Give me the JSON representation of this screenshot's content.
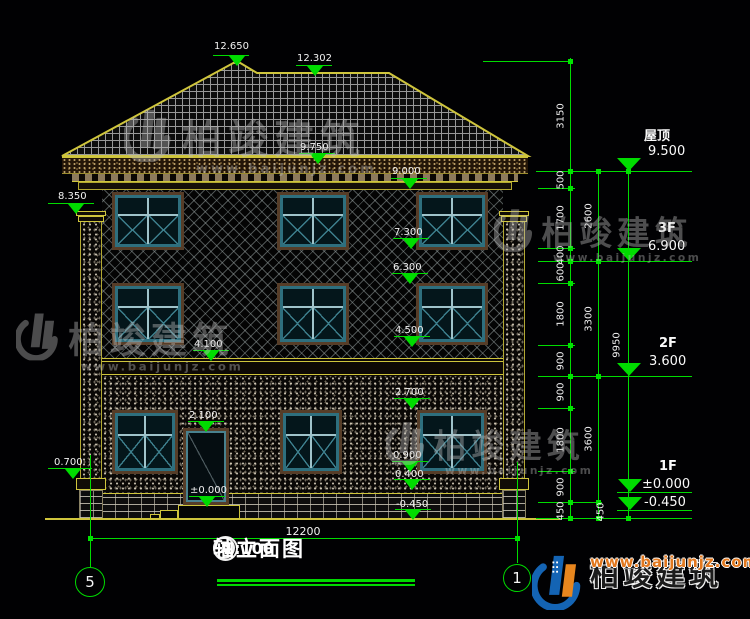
{
  "title": {
    "axis_left": "5",
    "axis_right": "1",
    "text": "轴立面图",
    "scale": "1:100"
  },
  "brand": {
    "name": "柏竣建筑",
    "url": "www.baijunjz.com"
  },
  "bottom_dim": {
    "label": "12200",
    "x1": 90,
    "x2": 517,
    "y": 538,
    "lx": 303,
    "ly": 525
  },
  "axis_bubbles": [
    {
      "label": "5",
      "cx": 90,
      "cy": 582,
      "r": 15,
      "line_top": 455,
      "line_bottom": 567
    },
    {
      "label": "1",
      "cx": 517,
      "cy": 578,
      "r": 14,
      "line_top": 462,
      "line_bottom": 563
    }
  ],
  "elevation_markers": [
    {
      "label": "12.650",
      "lx": 214,
      "ly": 41,
      "x1": 213,
      "x2": 249,
      "y": 55,
      "tx": 237
    },
    {
      "label": "12.302",
      "lx": 297,
      "ly": 53,
      "x1": 296,
      "x2": 332,
      "y": 65,
      "tx": 315
    },
    {
      "label": "9.750",
      "lx": 300,
      "ly": 142,
      "x1": 299,
      "x2": 335,
      "y": 153,
      "tx": 318
    },
    {
      "label": "9.000",
      "lx": 392,
      "ly": 166,
      "x1": 391,
      "x2": 427,
      "y": 178,
      "tx": 410
    },
    {
      "label": "8.350",
      "lx": 58,
      "ly": 191,
      "x1": 48,
      "x2": 94,
      "y": 203,
      "tx": 76
    },
    {
      "label": "7.300",
      "lx": 394,
      "ly": 227,
      "x1": 393,
      "x2": 429,
      "y": 238,
      "tx": 411
    },
    {
      "label": "6.300",
      "lx": 393,
      "ly": 262,
      "x1": 392,
      "x2": 428,
      "y": 273,
      "tx": 410
    },
    {
      "label": "4.500",
      "lx": 395,
      "ly": 325,
      "x1": 394,
      "x2": 430,
      "y": 336,
      "tx": 412
    },
    {
      "label": "4.100",
      "lx": 194,
      "ly": 339,
      "x1": 193,
      "x2": 229,
      "y": 350,
      "tx": 211
    },
    {
      "label": "2.700",
      "lx": 395,
      "ly": 387,
      "x1": 394,
      "x2": 430,
      "y": 398,
      "tx": 412
    },
    {
      "label": "2.100",
      "lx": 189,
      "ly": 410,
      "x1": 188,
      "x2": 224,
      "y": 421,
      "tx": 206
    },
    {
      "label": "0.900",
      "lx": 393,
      "ly": 450,
      "x1": 392,
      "x2": 428,
      "y": 461,
      "tx": 410
    },
    {
      "label": "0.400",
      "lx": 395,
      "ly": 469,
      "x1": 394,
      "x2": 430,
      "y": 479,
      "tx": 412
    },
    {
      "label": "±0.000",
      "lx": 190,
      "ly": 485,
      "x1": 189,
      "x2": 225,
      "y": 496,
      "tx": 207
    },
    {
      "label": "-0.450",
      "lx": 396,
      "ly": 499,
      "x1": 395,
      "x2": 431,
      "y": 509,
      "tx": 413
    },
    {
      "label": "0.700",
      "lx": 54,
      "ly": 457,
      "x1": 48,
      "x2": 92,
      "y": 468,
      "tx": 73
    }
  ],
  "level_markers": [
    {
      "floor": "屋顶",
      "fx": 644,
      "fy": 125,
      "value": "9.500",
      "vx": 648,
      "vy": 144,
      "tx": 629,
      "ty": 171
    },
    {
      "floor": "3F",
      "fx": 658,
      "fy": 221,
      "value": "6.900",
      "vx": 648,
      "vy": 239,
      "tx": 629,
      "ty": 261
    },
    {
      "floor": "2F",
      "fx": 659,
      "fy": 336,
      "value": "3.600",
      "vx": 649,
      "vy": 354,
      "tx": 629,
      "ty": 376
    },
    {
      "floor": "1F",
      "fx": 659,
      "fy": 459,
      "value": "±0.000",
      "vx": 642,
      "vy": 477,
      "tx": 630,
      "ty": 492
    },
    {
      "floor": "",
      "fx": 0,
      "fy": 0,
      "value": "-0.450",
      "vx": 644,
      "vy": 495,
      "tx": 630,
      "ty": 510
    }
  ],
  "chain_labels": [
    {
      "t": "3150",
      "x": 561,
      "y": 116
    },
    {
      "t": "500",
      "x": 561,
      "y": 180
    },
    {
      "t": "1700",
      "x": 561,
      "y": 218
    },
    {
      "t": "400",
      "x": 561,
      "y": 255
    },
    {
      "t": "600",
      "x": 561,
      "y": 272
    },
    {
      "t": "1800",
      "x": 561,
      "y": 314
    },
    {
      "t": "900",
      "x": 561,
      "y": 361
    },
    {
      "t": "900",
      "x": 561,
      "y": 392
    },
    {
      "t": "1800",
      "x": 561,
      "y": 440
    },
    {
      "t": "900",
      "x": 561,
      "y": 487
    },
    {
      "t": "450",
      "x": 561,
      "y": 511
    },
    {
      "t": "2600",
      "x": 589,
      "y": 216
    },
    {
      "t": "3300",
      "x": 589,
      "y": 319
    },
    {
      "t": "3600",
      "x": 589,
      "y": 439
    },
    {
      "t": "450",
      "x": 601,
      "y": 512
    },
    {
      "t": "9950",
      "x": 617,
      "y": 345
    }
  ],
  "green_v": [
    [
      570,
      58,
      519
    ],
    [
      598,
      171,
      519
    ],
    [
      628,
      171,
      519
    ]
  ],
  "green_h": [
    [
      483,
      571,
      61
    ],
    [
      536,
      692,
      171
    ],
    [
      538,
      575,
      188
    ],
    [
      538,
      575,
      248
    ],
    [
      538,
      692,
      261
    ],
    [
      538,
      575,
      283
    ],
    [
      538,
      575,
      345
    ],
    [
      538,
      692,
      376
    ],
    [
      538,
      575,
      408
    ],
    [
      538,
      575,
      471
    ],
    [
      538,
      602,
      502
    ],
    [
      536,
      692,
      518
    ],
    [
      617,
      692,
      492
    ],
    [
      617,
      692,
      510
    ]
  ],
  "ticks": [
    [
      570,
      61
    ],
    [
      570,
      171
    ],
    [
      570,
      188
    ],
    [
      570,
      248
    ],
    [
      570,
      261
    ],
    [
      570,
      283
    ],
    [
      570,
      345
    ],
    [
      570,
      376
    ],
    [
      570,
      408
    ],
    [
      570,
      471
    ],
    [
      570,
      502
    ],
    [
      570,
      518
    ],
    [
      598,
      171
    ],
    [
      598,
      261
    ],
    [
      598,
      376
    ],
    [
      598,
      502
    ],
    [
      598,
      518
    ],
    [
      628,
      171
    ],
    [
      628,
      518
    ],
    [
      90,
      538
    ],
    [
      517,
      538
    ]
  ],
  "yellow_h": [
    [
      102,
      503,
      361
    ],
    [
      102,
      503,
      374
    ]
  ],
  "windows": [
    {
      "x": 112,
      "y": 192,
      "w": 72,
      "h": 58
    },
    {
      "x": 277,
      "y": 192,
      "w": 72,
      "h": 58
    },
    {
      "x": 416,
      "y": 192,
      "w": 72,
      "h": 58
    },
    {
      "x": 112,
      "y": 283,
      "w": 72,
      "h": 62
    },
    {
      "x": 277,
      "y": 283,
      "w": 72,
      "h": 62
    },
    {
      "x": 416,
      "y": 283,
      "w": 72,
      "h": 62
    },
    {
      "x": 112,
      "y": 410,
      "w": 66,
      "h": 64
    },
    {
      "x": 280,
      "y": 410,
      "w": 62,
      "h": 64
    },
    {
      "x": 417,
      "y": 410,
      "w": 70,
      "h": 64
    }
  ],
  "door": {
    "x": 183,
    "y": 428,
    "w": 46,
    "h": 77
  },
  "steps": [
    [
      178,
      505,
      62,
      14
    ],
    [
      160,
      510,
      18,
      9
    ],
    [
      150,
      514,
      10,
      5
    ]
  ],
  "watermarks": [
    {
      "x": 124,
      "y": 106,
      "s": 1.0
    },
    {
      "x": 494,
      "y": 206,
      "s": 0.82
    },
    {
      "x": 16,
      "y": 310,
      "s": 0.9
    },
    {
      "x": 386,
      "y": 419,
      "s": 0.82
    }
  ]
}
